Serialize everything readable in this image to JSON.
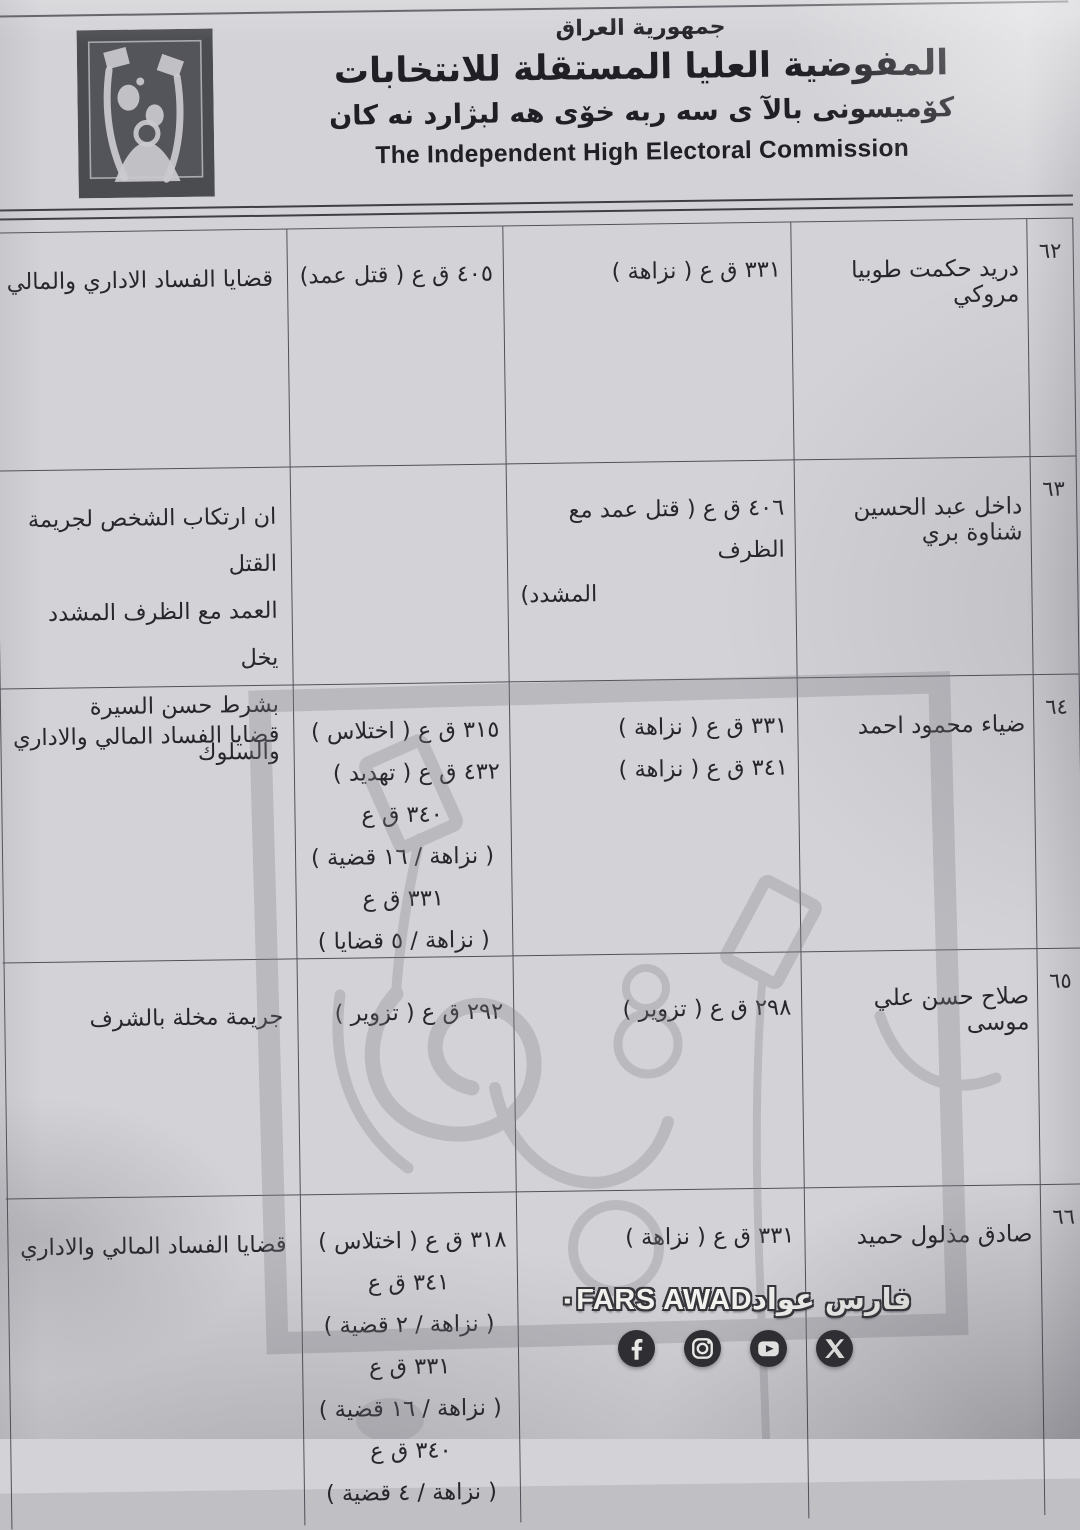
{
  "header": {
    "country": "جمهورية العراق",
    "title_ar": "المفوضية العليا المستقلة للانتخابات",
    "title_ku": "كۆميسونى بالآ ى  سه ربه خۆى هه لبژارد نه كان",
    "title_en": "The Independent High Electoral Commission",
    "logo": "ihec-ballot-figures-logo"
  },
  "table": {
    "rows": [
      {
        "no": "٦٢",
        "name": "دريد حكمت طوبيا مروكي",
        "articles_a": [
          "٣٣١ ق ع ( نزاهة )"
        ],
        "articles_b": [
          "٤٠٥ ق ع ( قتل عمد)"
        ],
        "notes": [
          "قضايا الفساد الاداري والمالي"
        ]
      },
      {
        "no": "٦٣",
        "name": "داخل عبد الحسين شناوة بري",
        "articles_a": [
          "٤٠٦ ق ع ( قتل عمد مع الظرف",
          "المشدد)"
        ],
        "articles_b": [],
        "notes": [
          "ان ارتكاب الشخص لجريمة القتل",
          "العمد مع الظرف المشدد يخل",
          "بشرط حسن السيرة والسلوك"
        ]
      },
      {
        "no": "٦٤",
        "name": "ضياء محمود احمد",
        "articles_a": [
          "٣٣١ ق ع ( نزاهة )",
          "٣٤١ ق ع ( نزاهة )"
        ],
        "articles_b": [
          "٣١٥ ق ع ( اختلاس )",
          "٤٣٢ ق ع ( تهديد )",
          "٣٤٠ ق ع",
          "( نزاهة / ١٦ قضية )",
          "٣٣١ ق ع",
          "( نزاهة / ٥ قضايا )"
        ],
        "notes": [
          "قضايا الفساد المالي والاداري"
        ]
      },
      {
        "no": "٦٥",
        "name": "صلاح حسن علي موسى",
        "articles_a": [
          "٢٩٨ ق ع ( تزوير )"
        ],
        "articles_b": [
          "٢٩٢ ق ع ( تزوير )"
        ],
        "notes": [
          "جريمة مخلة بالشرف"
        ]
      },
      {
        "no": "٦٦",
        "name": "صادق مذلول حميد",
        "articles_a": [
          "٣٣١ ق ع ( نزاهة )"
        ],
        "articles_b": [
          "٣١٨ ق ع ( اختلاس )",
          "٣٤١ ق ع",
          "( نزاهة / ٢ قضية )",
          "٣٣١ ق ع",
          "( نزاهة / ١٦ قضية )",
          "٣٤٠ ق ع",
          "( نزاهة / ٤ قضية )"
        ],
        "notes": [
          "قضايا الفساد المالي والاداري"
        ]
      }
    ]
  },
  "credit": {
    "name_ar": "فارس عواد",
    "separator": "٠",
    "name_en": "FARS AWAD",
    "icons": [
      "facebook-icon",
      "instagram-icon",
      "youtube-icon",
      "x-icon"
    ]
  },
  "colors": {
    "paper": "#d3d3d7",
    "ink": "#26262c",
    "table_line": "#50505a",
    "logo_bg": "#4b4c50",
    "watermark_gray": "#7f7f87",
    "icon_circle": "#2d2d32"
  }
}
